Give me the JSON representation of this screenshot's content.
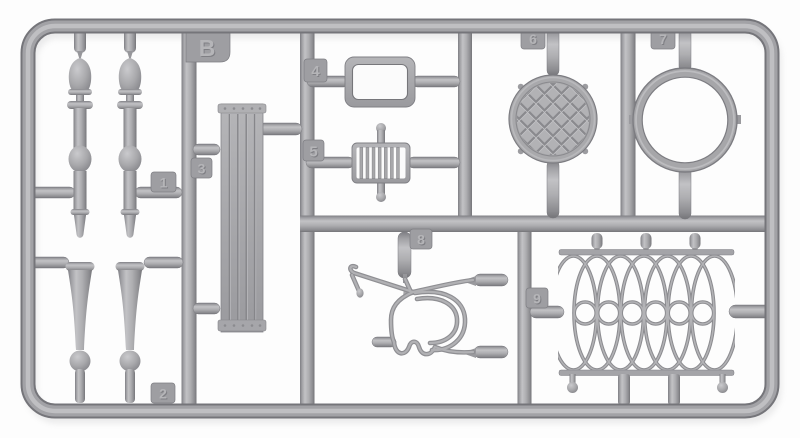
{
  "photo": {
    "subject": "injection-molded plastic model kit sprue on white background",
    "background_color": "#fdfdfd",
    "plastic_color": "#a8a8ac",
    "plastic_highlight": "#c2c2c5",
    "plastic_shadow": "#7b7b80",
    "sprue_letter": "B",
    "tags": {
      "b": "B",
      "t1": "1",
      "t2": "2",
      "t3": "3",
      "t4": "4",
      "t5": "5",
      "t6": "6",
      "t7": "7",
      "t8": "8",
      "t9": "9"
    },
    "parts": [
      {
        "number": "1",
        "shape": "turned baluster column, two copies"
      },
      {
        "number": "2",
        "shape": "tapered furniture leg, two copies"
      },
      {
        "number": "3",
        "shape": "planked rectangular panel with riveted end caps"
      },
      {
        "number": "4",
        "shape": "rectangular open frame"
      },
      {
        "number": "5",
        "shape": "slatted grille with pin ends"
      },
      {
        "number": "6",
        "shape": "round waffle-pattern table top"
      },
      {
        "number": "7",
        "shape": "circular ring rim"
      },
      {
        "number": "8",
        "shape": "bent-wire chair frame"
      },
      {
        "number": "9",
        "shape": "decorative oval-lattice fence panel"
      }
    ]
  }
}
